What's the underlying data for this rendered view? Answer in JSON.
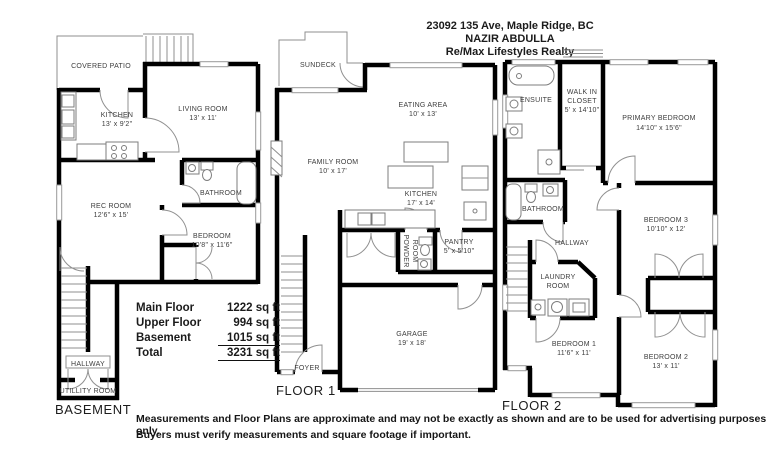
{
  "header": {
    "address": "23092 135 Ave, Maple Ridge, BC",
    "agent": "NAZIR ABDULLA",
    "brokerage": "Re/Max Lifestyles Realty"
  },
  "area_table": {
    "rows": [
      {
        "label": "Main  Floor",
        "value": "1222 sq ft"
      },
      {
        "label": "Upper Floor",
        "value": "994 sq ft"
      },
      {
        "label": "Basement",
        "value": "1015 sq ft"
      },
      {
        "label": "Total",
        "value": "3231 sq ft"
      }
    ]
  },
  "plans": {
    "basement": {
      "title": "BASEMENT",
      "rooms": {
        "covered_patio": {
          "name": "COVERED PATIO"
        },
        "kitchen": {
          "name": "KITCHEN",
          "dims": "13' x 9'2\""
        },
        "living": {
          "name": "LIVING ROOM",
          "dims": "13' x 11'"
        },
        "bathroom": {
          "name": "BATHROOM"
        },
        "rec": {
          "name": "REC ROOM",
          "dims": "12'6\" x 15'"
        },
        "bedroom": {
          "name": "BEDROOM",
          "dims": "10'8\" x 11'6\""
        },
        "hallway": {
          "name": "HALLWAY"
        },
        "utility": {
          "name": "UTILLITY ROOM"
        }
      }
    },
    "floor1": {
      "title": "FLOOR 1",
      "rooms": {
        "sundeck": {
          "name": "SUNDECK"
        },
        "eating": {
          "name": "EATING AREA",
          "dims": "10' x 13'"
        },
        "family": {
          "name": "FAMILY ROOM",
          "dims": "10' x 17'"
        },
        "kitchen": {
          "name": "KITCHEN",
          "dims": "17' x 14'"
        },
        "powder": {
          "line1": "POWDER",
          "line2": "ROOM"
        },
        "pantry": {
          "name": "PANTRY",
          "dims": "5' x 5'10\""
        },
        "foyer": {
          "name": "FOYER"
        },
        "garage": {
          "name": "GARAGE",
          "dims": "19' x 18'"
        }
      }
    },
    "floor2": {
      "title": "FLOOR 2",
      "rooms": {
        "ensuite": {
          "name": "ENSUITE"
        },
        "walkin": {
          "line1": "WALK IN",
          "line2": "CLOSET",
          "dims": "5' x 14'10\""
        },
        "primary": {
          "name": "PRIMARY BEDROOM",
          "dims": "14'10\" x 15'6\""
        },
        "bathroom": {
          "name": "BATHROOM"
        },
        "hallway": {
          "name": "HALLWAY"
        },
        "bedroom3": {
          "name": "BEDROOM 3",
          "dims": "10'10\" x 12'"
        },
        "laundry": {
          "line1": "LAUNDRY",
          "line2": "ROOM"
        },
        "bedroom1": {
          "name": "BEDROOM 1",
          "dims": "11'6\" x 11'"
        },
        "bedroom2": {
          "name": "BEDROOM 2",
          "dims": "13' x 11'"
        }
      }
    }
  },
  "disclaimer": {
    "line1": "Measurements and Floor Plans are approximate and may not be exactly as shown and are to be used for advertising purposes only.",
    "line2": "Buyers must verify measurements and square footage if important."
  },
  "colors": {
    "wall": "#000000",
    "thin_line": "#8f8f8f",
    "text": "#3d3d3d"
  }
}
